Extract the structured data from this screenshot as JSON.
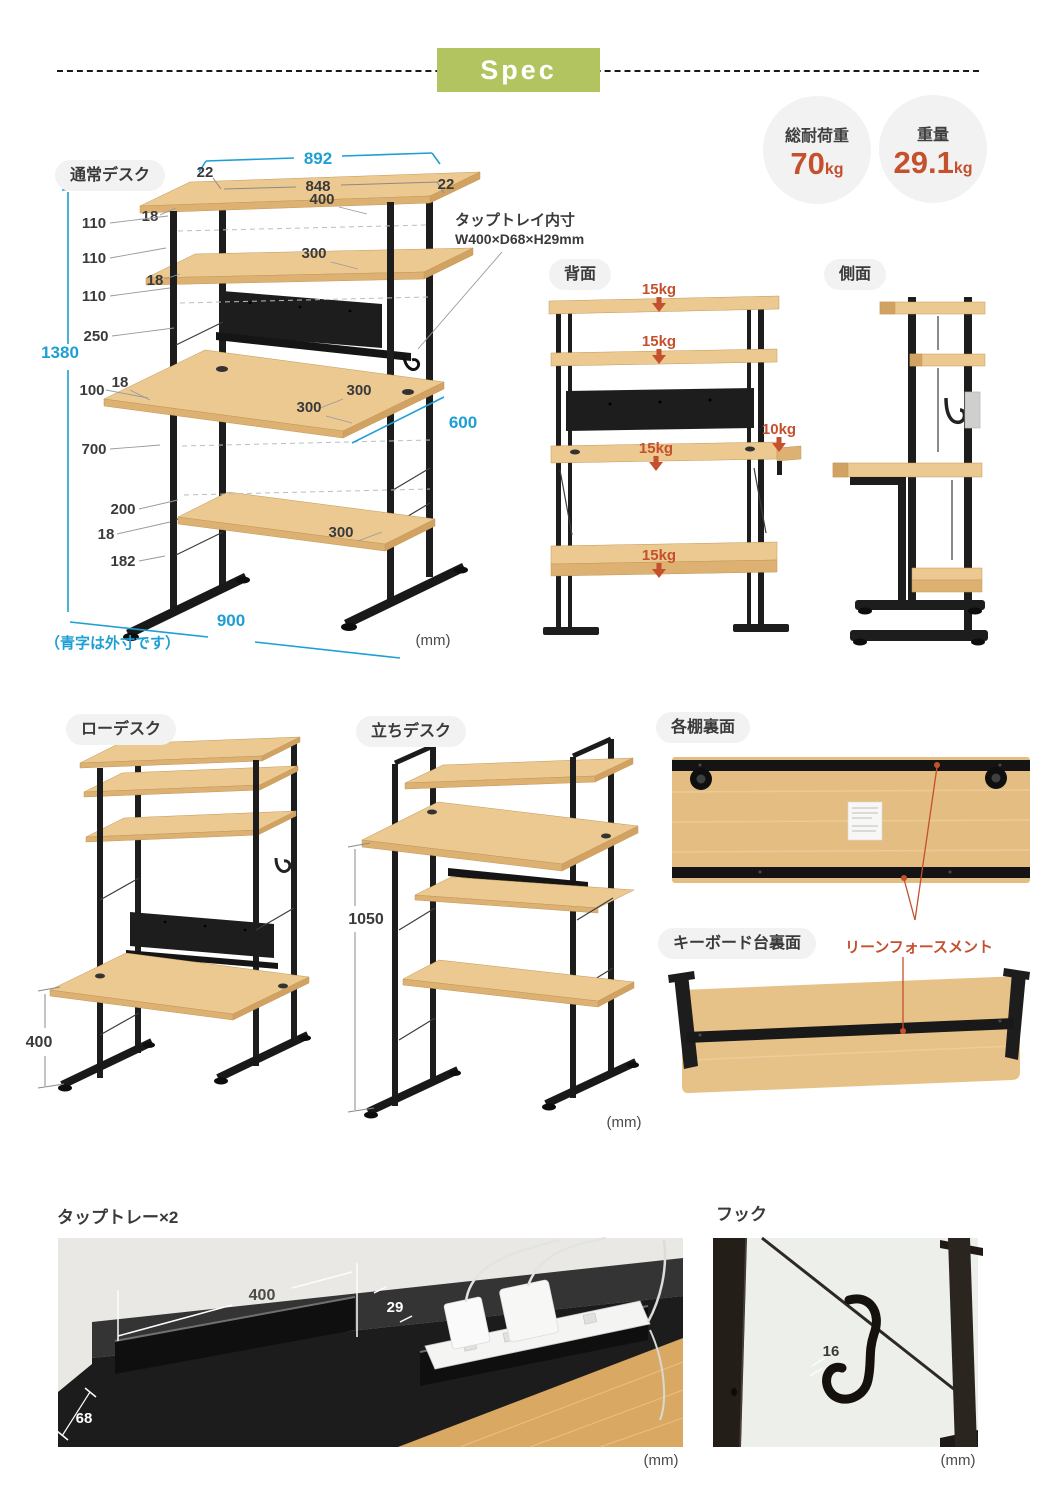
{
  "colors": {
    "accent_blue": "#1e9fd4",
    "accent_orange": "#c4502d",
    "banner_green": "#b2c45f",
    "wood": "#ecc990",
    "frame_black": "#1d1d1d",
    "pill_bg": "#f2f2f2"
  },
  "header": {
    "title": "Spec"
  },
  "badges": {
    "load": {
      "label": "総耐荷重",
      "value": "70",
      "unit": "kg"
    },
    "weight": {
      "label": "重量",
      "value": "29.1",
      "unit": "kg"
    }
  },
  "normal_desk": {
    "label": "通常デスク",
    "note": "（青字は外寸です）",
    "unit": "(mm)",
    "tap_note1": "タップトレイ内寸",
    "tap_note2": "W400×D68×H29mm",
    "dims": {
      "outer_width": "892",
      "left_overhang": "22",
      "inner_width": "848",
      "top_shelf_width": "400",
      "right_overhang": "22",
      "top_thickness": "18",
      "gap1": "110",
      "gap2": "110",
      "shelf2_thickness": "18",
      "gap3": "110",
      "gap4": "250",
      "outer_height": "1380",
      "gap5": "100",
      "desk_thickness": "18",
      "desk_height": "700",
      "gap6": "200",
      "bottom_thickness": "18",
      "floor_clearance": "182",
      "top_shelf_depth": "300",
      "desk_back_depth": "300",
      "desk_front_depth": "300",
      "bottom_shelf_depth": "300",
      "outer_depth": "600",
      "outer_base_width": "900"
    }
  },
  "back_view": {
    "label": "背面",
    "loads": {
      "top": "15kg",
      "shelf2": "15kg",
      "desk": "15kg",
      "side": "10kg",
      "bottom": "15kg"
    }
  },
  "side_view": {
    "label": "側面"
  },
  "low_desk": {
    "label": "ローデスク",
    "dims": {
      "desk_height": "400"
    }
  },
  "standing_desk": {
    "label": "立ちデスク",
    "dims": {
      "desk_height": "1050"
    },
    "unit": "(mm)"
  },
  "shelf_back": {
    "label": "各棚裏面"
  },
  "keyboard_back": {
    "label": "キーボード台裏面",
    "annotation": "リーンフォースメント"
  },
  "tap_tray": {
    "label": "タップトレー×2",
    "dims": {
      "width": "400",
      "slot": "29",
      "depth": "68"
    },
    "unit": "(mm)"
  },
  "hook": {
    "label": "フック",
    "dims": {
      "opening": "16"
    },
    "unit": "(mm)"
  }
}
